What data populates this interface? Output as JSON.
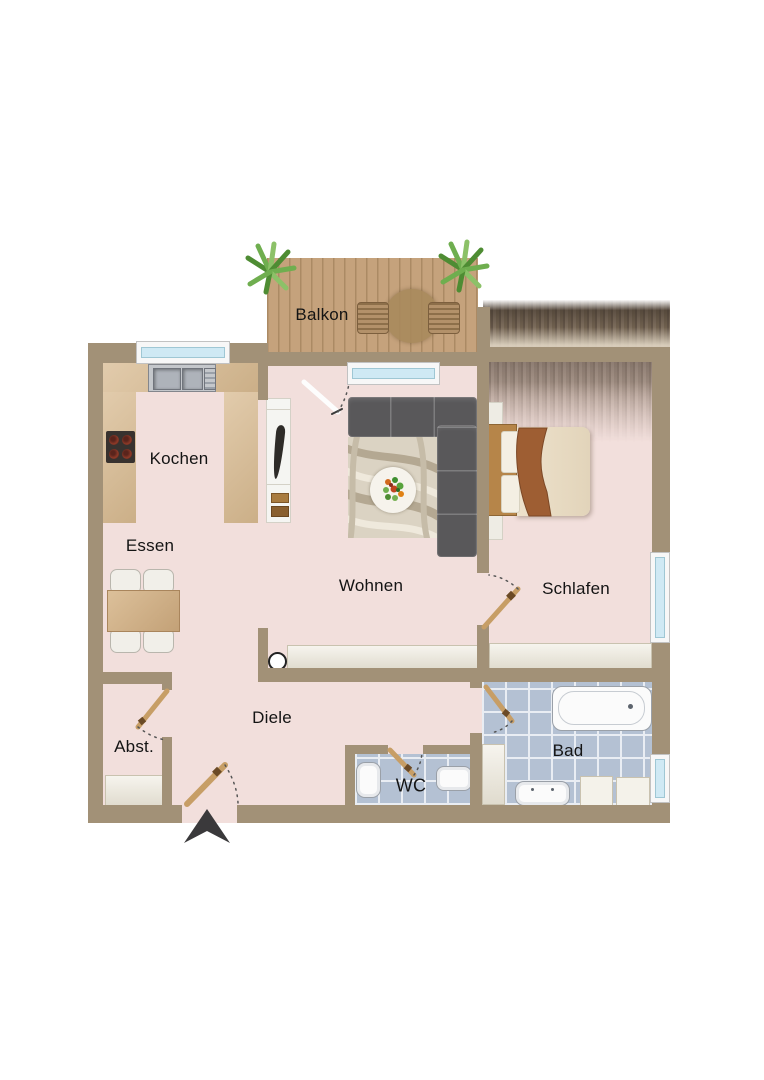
{
  "rooms": [
    {
      "id": "balkon",
      "label": "Balkon"
    },
    {
      "id": "kochen",
      "label": "Kochen"
    },
    {
      "id": "essen",
      "label": "Essen"
    },
    {
      "id": "wohnen",
      "label": "Wohnen"
    },
    {
      "id": "schlafen",
      "label": "Schlafen"
    },
    {
      "id": "diele",
      "label": "Diele"
    },
    {
      "id": "abst",
      "label": "Abst."
    },
    {
      "id": "wc",
      "label": "WC"
    },
    {
      "id": "bad",
      "label": "Bad"
    }
  ],
  "colors": {
    "wall": "#a29177",
    "floor": "#f2dfdc",
    "counter": "#d8ba90",
    "deck": "#c5a27c",
    "deck_line": "#ab8a64",
    "tile": "#b4c1d3",
    "grout": "#e9edf3",
    "sofa": "#59585a",
    "rug_base": "#dbd3c3",
    "rug_swirl": "#b4a892",
    "cream": "#ece7d9",
    "bed": "#e7dac2",
    "wood": "#b68549",
    "throw": "#9e5e33",
    "door": "#c79e66",
    "glass": "#cfe9f4",
    "frame": "#f7f7f7",
    "arrow": "#3a393b",
    "plant": "#5d9a3c",
    "label": "#141414"
  }
}
